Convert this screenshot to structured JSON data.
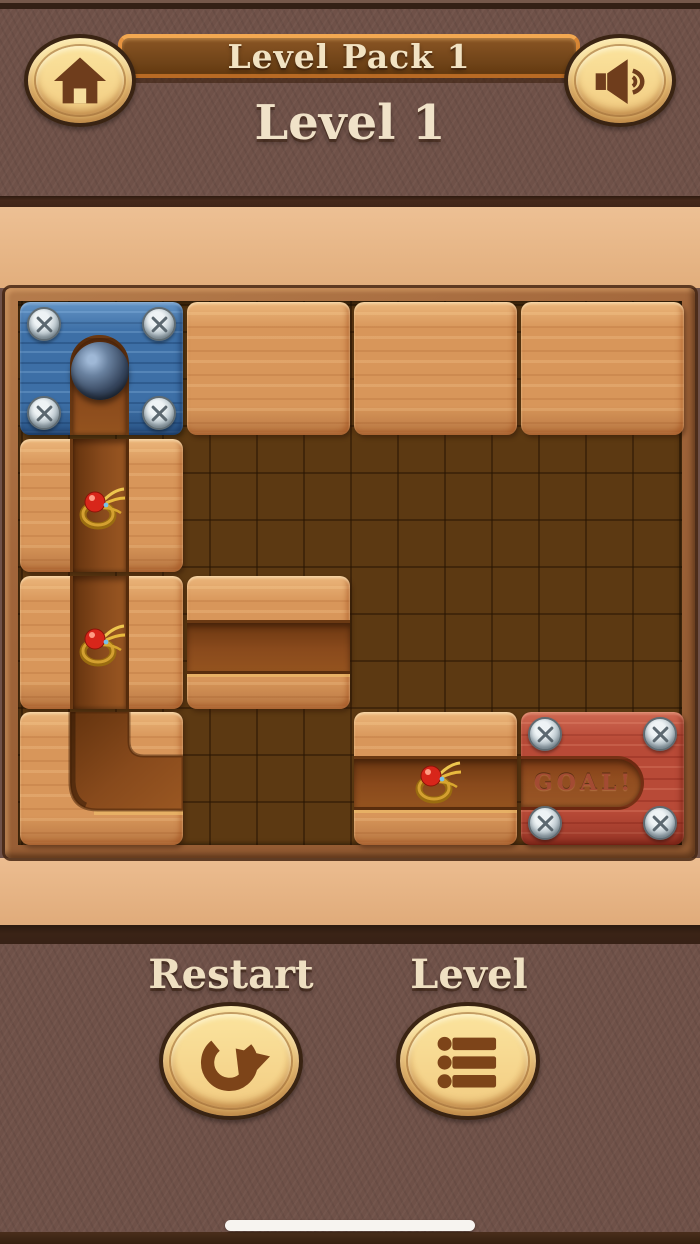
{
  "header": {
    "pack_banner": "Level Pack 1",
    "level_title": "Level 1",
    "home_icon": "home-icon",
    "sound_icon": "speaker-icon"
  },
  "board": {
    "goal_label": "GOAL!",
    "grid": {
      "rows": 4,
      "cols": 4
    },
    "tiles": [
      {
        "type": "ball-start-fixed",
        "row": 1,
        "col": 1,
        "color": "blue",
        "contains": "ball",
        "screws": 4
      },
      {
        "type": "wood-block",
        "row": 1,
        "col": 2
      },
      {
        "type": "wood-block",
        "row": 1,
        "col": 3
      },
      {
        "type": "wood-block",
        "row": 1,
        "col": 4
      },
      {
        "type": "pipe-vertical",
        "row": 2,
        "col": 1,
        "contains": "gem-ring"
      },
      {
        "type": "pipe-vertical",
        "row": 3,
        "col": 1,
        "contains": "gem-ring"
      },
      {
        "type": "pipe-horizontal",
        "row": 3,
        "col": 2
      },
      {
        "type": "pipe-elbow-top-to-right",
        "row": 4,
        "col": 1
      },
      {
        "type": "pipe-horizontal",
        "row": 4,
        "col": 3,
        "contains": "gem-ring"
      },
      {
        "type": "goal-fixed",
        "row": 4,
        "col": 4,
        "color": "red",
        "label": "GOAL!",
        "screws": 4
      }
    ]
  },
  "footer": {
    "restart_label": "Restart",
    "level_label": "Level",
    "restart_icon": "restart-arrow-icon",
    "level_icon": "level-list-icon"
  },
  "system": {
    "home_indicator": "home-indicator-bar"
  },
  "colors": {
    "background_brown": "#6f5148",
    "tan_band": "#e2ae7c",
    "board_pit": "#5c3912",
    "wood_tile": "#d8965a",
    "blue_tile": "#3d6fa6",
    "goal_red": "#b84a37",
    "channel_brown": "#8a4a1c",
    "cream_text": "#f0e2c8",
    "goal_text": "#a34b33",
    "button_gold": "#f6d98e",
    "icon_brown": "#7d4419"
  }
}
